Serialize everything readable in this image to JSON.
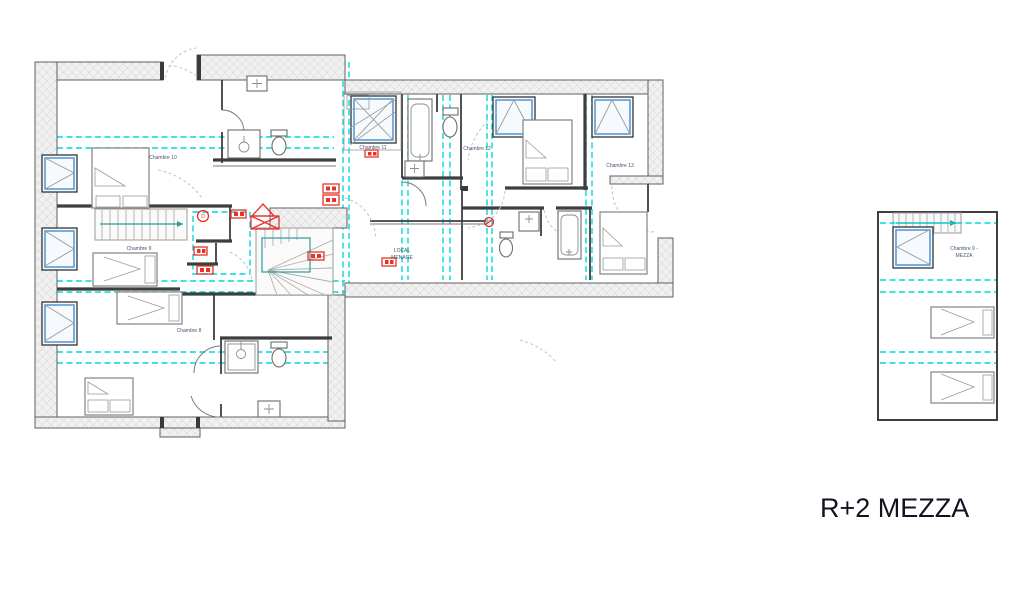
{
  "title": "R+2 MEZZA",
  "rooms": {
    "c8": "Chambre 8",
    "c9": "Chambre 9",
    "c10": "Chambre 10",
    "c11": "Chambre 11",
    "c12": "Chambre 12",
    "c13": "Chambre 13",
    "local1": "LOCAL",
    "local2": "MENAGE",
    "mezza1": "Chambre 9 -",
    "mezza2": "MEZZA"
  },
  "markers": {
    "door_marker": "D"
  },
  "colors": {
    "guide_cyan": "#00d9d9",
    "alert_red": "#e63329",
    "skylight_blue": "#5b9bd5",
    "stair_teal": "#2a9d9d",
    "wall_gray": "#5f5f5f",
    "label_blue_gray": "#44546a",
    "title_dark": "#10131f"
  }
}
